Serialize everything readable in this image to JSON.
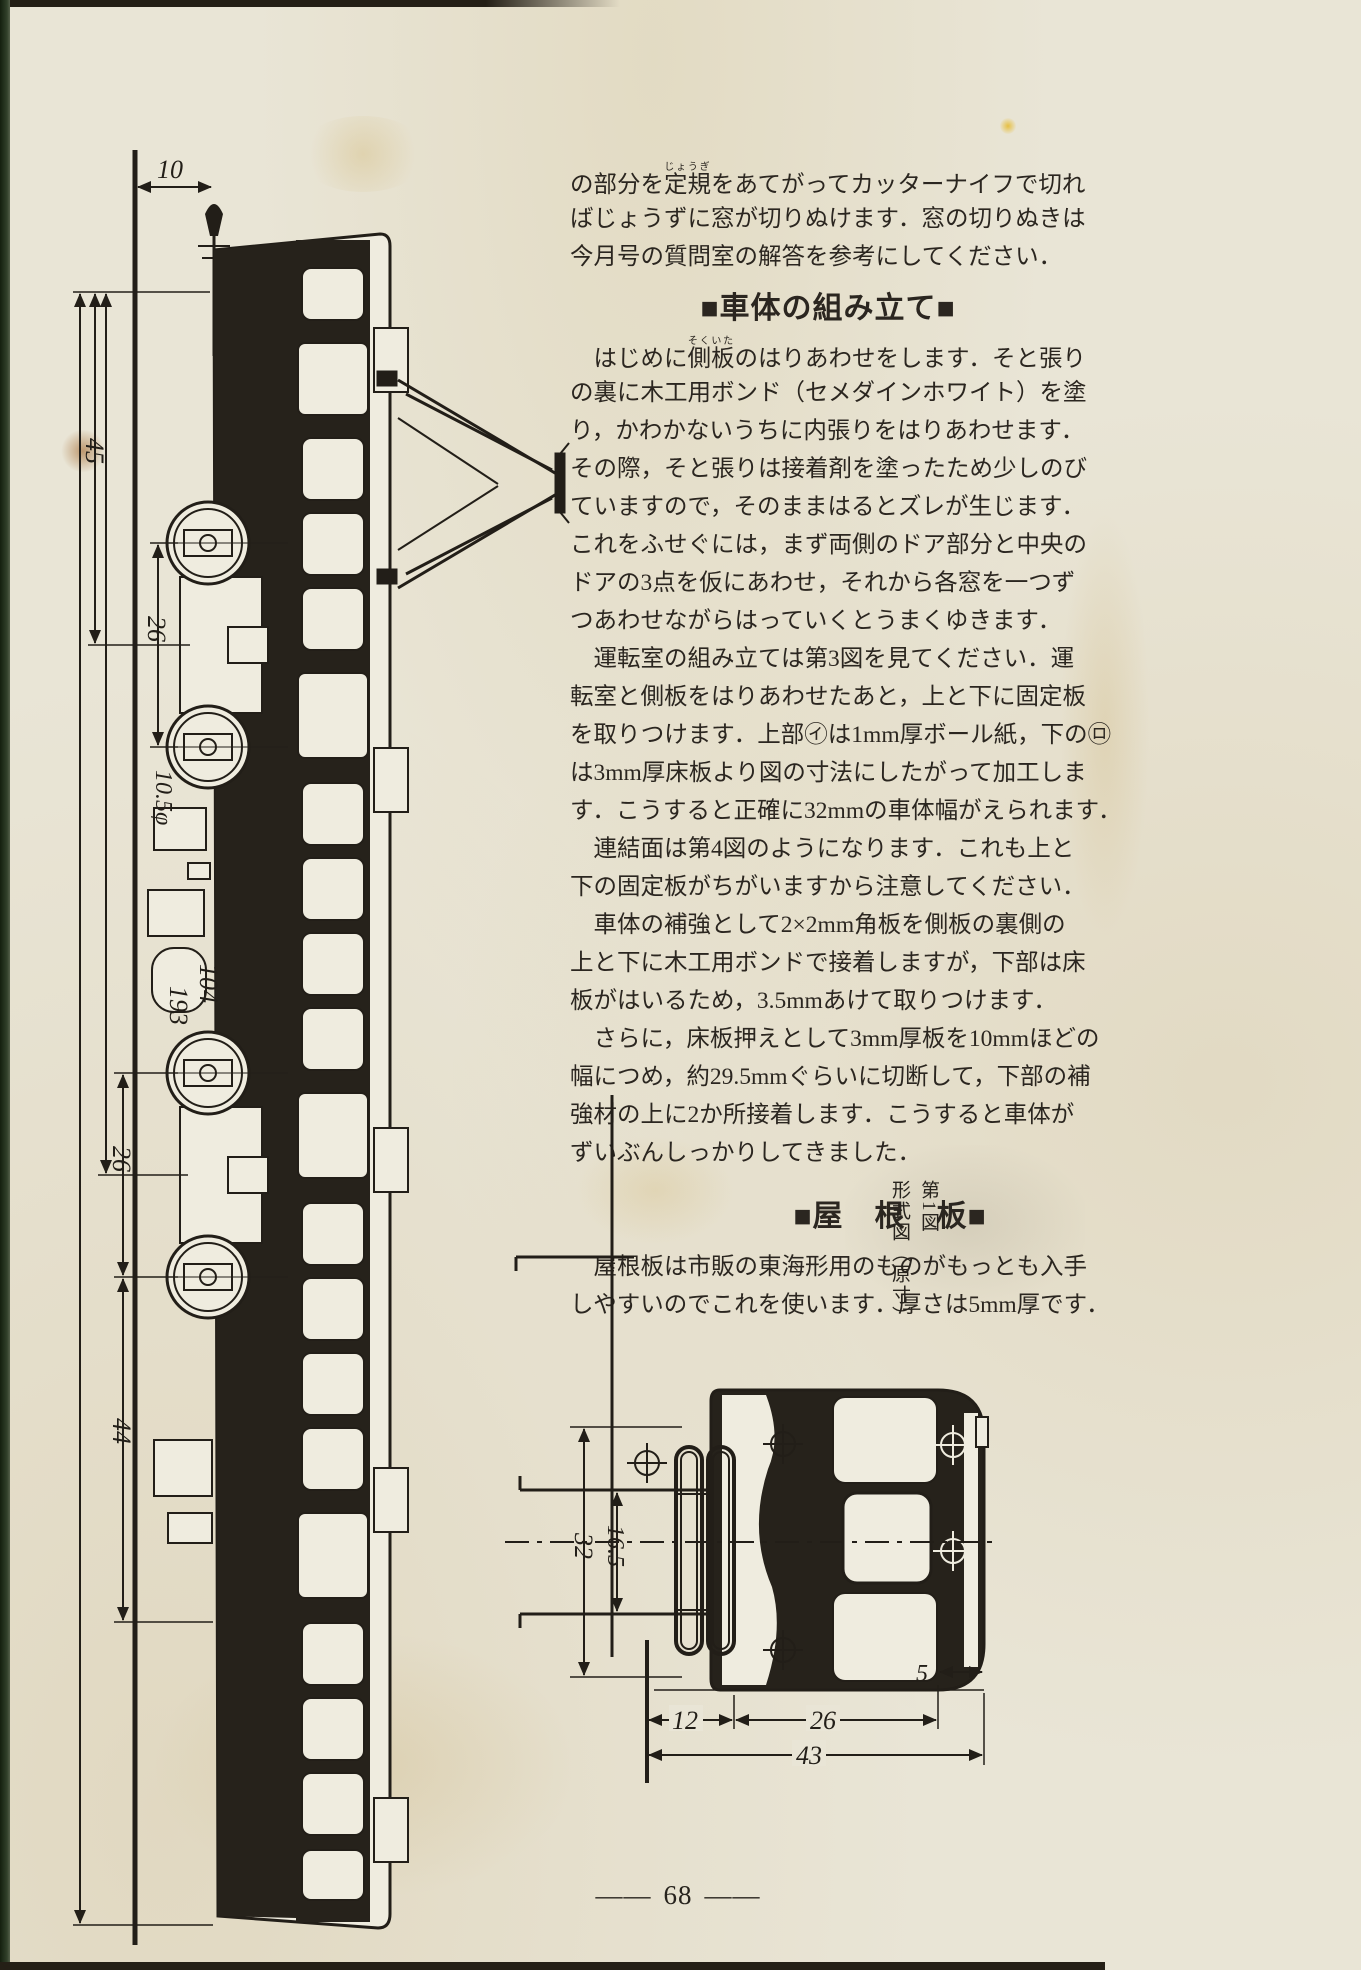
{
  "page": {
    "number": "68",
    "dash": "――",
    "paper_color": "#e9e5d6",
    "ink_color": "#2b2620"
  },
  "article": {
    "intro": {
      "line1": {
        "pre": "の部分を",
        "base": "定規",
        "ruby": "じょうぎ",
        "post": "をあてがってカッターナイフで切れ"
      },
      "lines": [
        "ばじょうずに窓が切りぬけます．窓の切りぬきは",
        "今月号の質問室の解答を参考にしてください．"
      ]
    },
    "section_body": {
      "heading": "■車体の組み立て■",
      "p1": {
        "line1": {
          "pre": "　はじめに",
          "base": "側板",
          "ruby": "そくいた",
          "post": "のはりあわせをします．そと張り"
        },
        "lines": [
          "の裏に木工用ボンド（セメダインホワイト）を塗",
          "り，かわかないうちに内張りをはりあわせます．",
          "その際，そと張りは接着剤を塗ったため少しのび",
          "ていますので，そのままはるとズレが生じます．",
          "これをふせぐには，まず両側のドア部分と中央の",
          "ドアの3点を仮にあわせ，それから各窓を一つず",
          "つあわせながらはっていくとうまくゆきます．"
        ]
      },
      "p2": {
        "lines": [
          "　運転室の組み立ては第3図を見てください．運",
          "転室と側板をはりあわせたあと，上と下に固定板",
          "を取りつけます．上部㋑は1mm厚ボール紙，下の㋺",
          "は3mm厚床板より図の寸法にしたがって加工しま",
          "す．こうすると正確に32mmの車体幅がえられます．"
        ]
      },
      "p3": {
        "lines": [
          "　連結面は第4図のようになります．これも上と",
          "下の固定板がちがいますから注意してください．"
        ]
      },
      "p4": {
        "lines": [
          "　車体の補強として2×2mm角板を側板の裏側の",
          "上と下に木工用ボンドで接着しますが，下部は床",
          "板がはいるため，3.5mmあけて取りつけます．"
        ]
      },
      "p5": {
        "lines": [
          "　さらに，床板押えとして3mm厚板を10mmほどの",
          "幅につめ，約29.5mmぐらいに切断して，下部の補",
          "強材の上に2か所接着します．こうすると車体が",
          "ずいぶんしっかりしてきました．"
        ]
      }
    },
    "section_roof": {
      "heading": "■屋　根　板■",
      "p1": {
        "lines": [
          "　屋根板は市販の東海形用のものがもっとも入手",
          "しやすいのでこれを使います．厚さは5mm厚です．"
        ]
      }
    }
  },
  "figure": {
    "caption_no": "第1図",
    "caption_title": "形式図（原寸）",
    "side_view": {
      "dims": {
        "pole_offset": "10",
        "front_overhang": "45",
        "wheelbase_front": "26",
        "wheel_diameter": "10.5φ",
        "bogie_distance": "104",
        "body_length": "193",
        "wheelbase_rear": "26",
        "rear_overhang": "44"
      }
    },
    "front_view": {
      "dims": {
        "body_height": "32",
        "panto_span": "16.5",
        "roof_section": "12",
        "window_band": "26",
        "edge": "5",
        "total_width": "43"
      }
    }
  }
}
